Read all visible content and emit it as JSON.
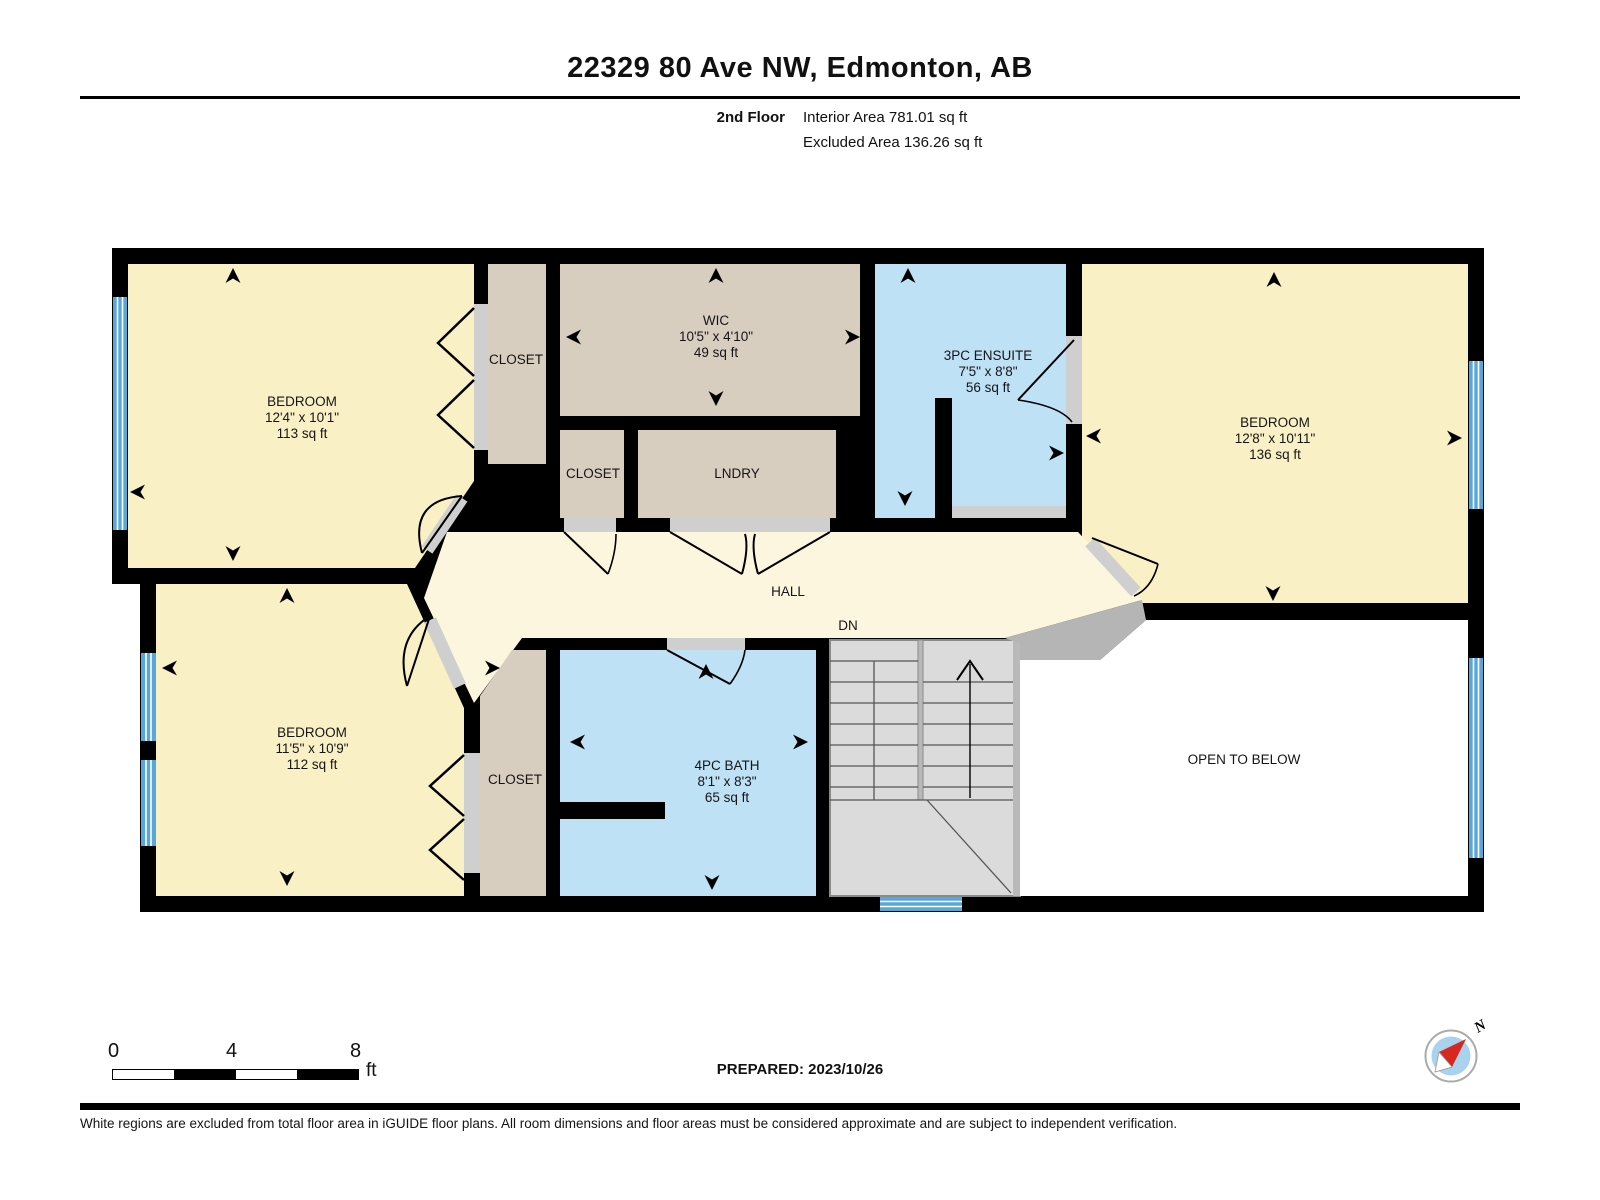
{
  "header": {
    "title": "22329 80 Ave NW, Edmonton, AB",
    "floor_label": "2nd Floor",
    "interior_area": "Interior Area 781.01 sq ft",
    "excluded_area": "Excluded Area 136.26 sq ft"
  },
  "rooms": {
    "bedroom_tl": {
      "name": "BEDROOM",
      "dims": "12'4\" x 10'1\"",
      "area": "113 sq ft"
    },
    "closet_tl": {
      "name": "CLOSET"
    },
    "wic": {
      "name": "WIC",
      "dims": "10'5\" x 4'10\"",
      "area": "49 sq ft"
    },
    "ensuite": {
      "name": "3PC ENSUITE",
      "dims": "7'5\" x 8'8\"",
      "area": "56 sq ft"
    },
    "bedroom_right": {
      "name": "BEDROOM",
      "dims": "12'8\" x 10'11\"",
      "area": "136 sq ft"
    },
    "closet_mid": {
      "name": "CLOSET"
    },
    "laundry": {
      "name": "LNDRY"
    },
    "hall": {
      "name": "HALL"
    },
    "stairs_direction": "DN",
    "bedroom_bl": {
      "name": "BEDROOM",
      "dims": "11'5\" x 10'9\"",
      "area": "112 sq ft"
    },
    "closet_bl": {
      "name": "CLOSET"
    },
    "bath": {
      "name": "4PC BATH",
      "dims": "8'1\" x 8'3\"",
      "area": "65 sq ft"
    },
    "open_to_below": {
      "name": "OPEN TO BELOW"
    }
  },
  "scale_bar": {
    "tick_0": "0",
    "tick_4": "4",
    "tick_8": "8",
    "unit": "ft"
  },
  "compass": {
    "north_label": "N"
  },
  "footer": {
    "prepared": "PREPARED: 2023/10/26",
    "disclaimer": "White regions are excluded from total floor area in iGUIDE floor plans. All room dimensions and floor areas must be considered approximate and are subject to independent verification."
  },
  "colors": {
    "wall": "#000000",
    "bedroom_fill": "#FAF0C6",
    "hall_fill": "#FDF6DF",
    "closet_fill": "#D8CEC0",
    "wet_room_fill": "#BEE1F5",
    "window_blue": "#57A7DB",
    "stairs_gray": "#DBDBDB",
    "door_opening_gray": "#CFCFCF",
    "open_area": "#FFFFFF"
  }
}
